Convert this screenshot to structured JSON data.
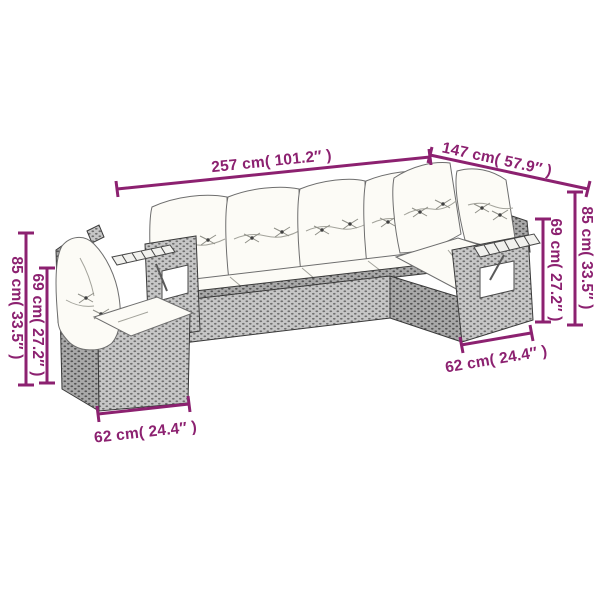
{
  "diagram": {
    "type": "furniture-dimension-diagram",
    "subject": "rattan corner sofa set with cushions",
    "background": "#ffffff"
  },
  "dimensions": {
    "width_total": {
      "label": "257 cm( 101.2″ )"
    },
    "depth_total": {
      "label": "147 cm( 57.9″ )"
    },
    "height_right_total": {
      "label": "85 cm( 33.5″ )"
    },
    "height_right_back": {
      "label": "69 cm( 27.2″ )"
    },
    "seat_right_depth": {
      "label": "62 cm( 24.4″ )"
    },
    "height_left_total": {
      "label": "85 cm( 33.5″ )"
    },
    "height_left_back": {
      "label": "69 cm( 27.2″ )"
    },
    "seat_left_depth": {
      "label": "62 cm( 24.4″ )"
    }
  },
  "colors": {
    "dimension_line": "#8c2170",
    "wicker_gray": "#c6c6c6",
    "wicker_dark": "#adadad",
    "cushion_white": "#fcfbf6",
    "outline": "#3a3a3a"
  }
}
